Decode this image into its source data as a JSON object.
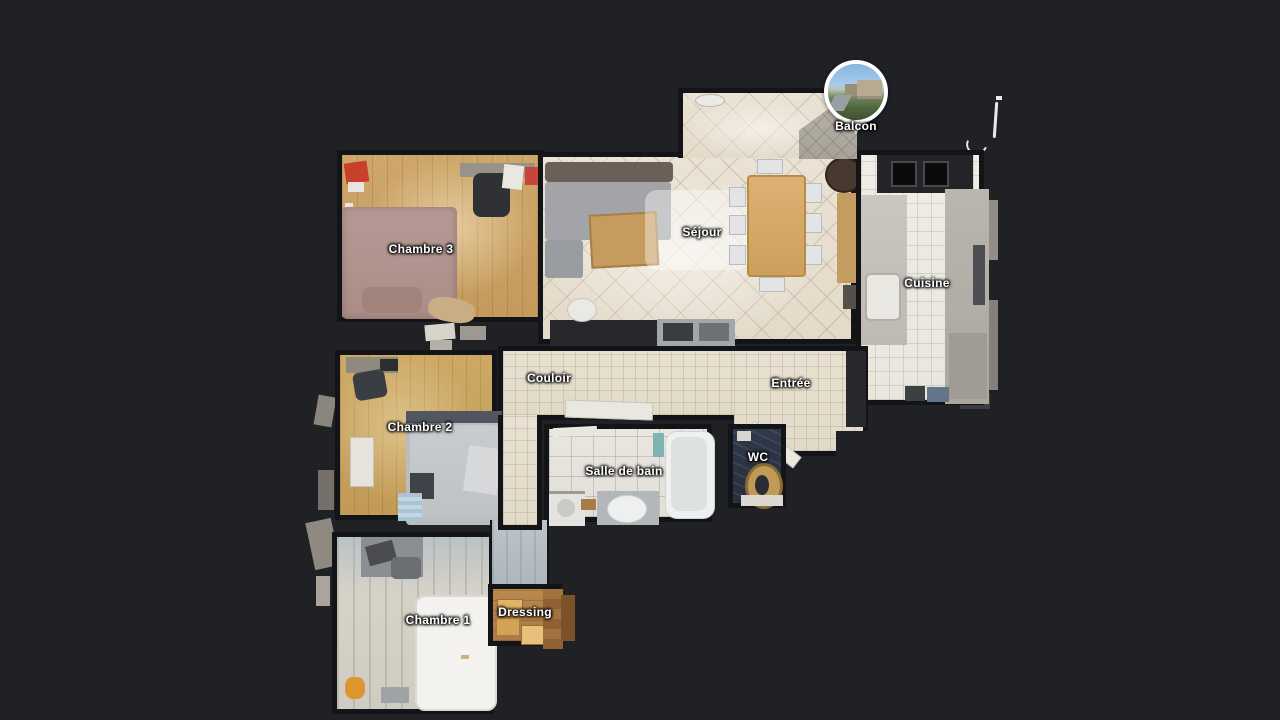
{
  "scene": {
    "view": "floorplan-top-down",
    "background_color": "#1f2124"
  },
  "pin": {
    "label": "Balcon",
    "icon": "panorama-photo-pin-icon",
    "ring_color": "#ffffff"
  },
  "rooms": [
    {
      "id": "chambre-3",
      "label": "Chambre 3"
    },
    {
      "id": "sejour",
      "label": "Séjour"
    },
    {
      "id": "cuisine",
      "label": "Cuisine"
    },
    {
      "id": "couloir",
      "label": "Couloir"
    },
    {
      "id": "entree",
      "label": "Entrée"
    },
    {
      "id": "chambre-2",
      "label": "Chambre 2"
    },
    {
      "id": "salle-de-bain",
      "label": "Salle de bain"
    },
    {
      "id": "wc",
      "label": "WC"
    },
    {
      "id": "chambre-1",
      "label": "Chambre 1"
    },
    {
      "id": "dressing",
      "label": "Dressing"
    }
  ],
  "palette": {
    "label_text": "#ffffff",
    "label_outline": "#000000",
    "tile_beige": "#e8e0d2",
    "tile_white": "#edebe3",
    "wood_oak": "#c9a065",
    "wood_pale": "#d5d1c7",
    "wc_floor": "#2d3542",
    "wall": "#131417"
  }
}
